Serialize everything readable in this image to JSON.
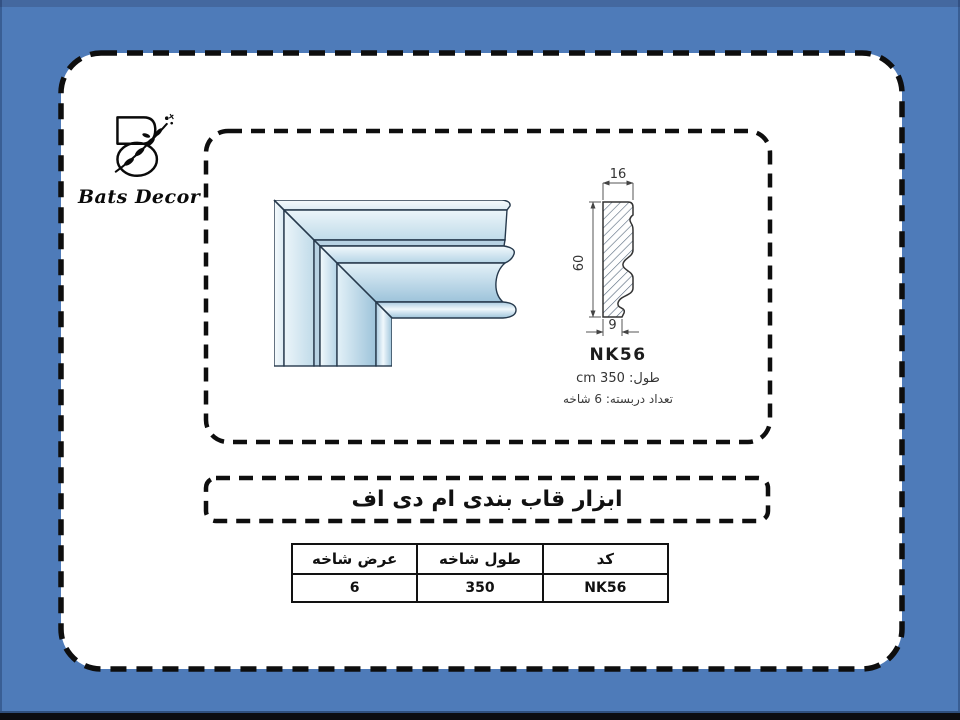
{
  "brand": {
    "name": "Bats Decor"
  },
  "title": "ابزار قاب بندی ام دی اف",
  "drawing": {
    "code": "NK56",
    "dim_top": "16",
    "dim_side": "60",
    "dim_bottom": "9",
    "length_label": "طول: 350 cm",
    "pack_label": "تعداد دربسته: 6 شاخه"
  },
  "table": {
    "headers": [
      "عرض شاخه",
      "طول شاخه",
      "کد"
    ],
    "row": [
      "6",
      "350",
      "NK56"
    ]
  },
  "colors": {
    "slide_bg": "#4e7bb9",
    "dash_border": "#0e0e0e",
    "molding_light": "#eef6fb",
    "molding_shade": "#9dc3da"
  }
}
